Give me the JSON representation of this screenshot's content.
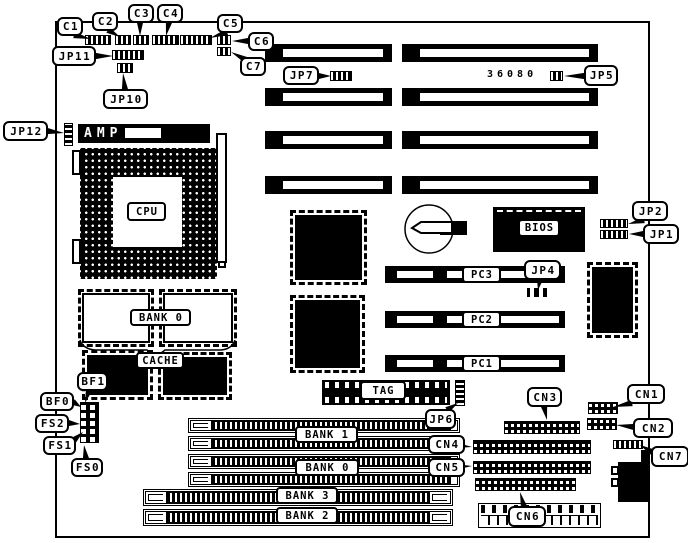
{
  "part_number": "36080",
  "callouts": {
    "c1": "C1",
    "c2": "C2",
    "c3": "C3",
    "c4": "C4",
    "c5": "C5",
    "c6": "C6",
    "c7": "C7",
    "jp11": "JP11",
    "jp10": "JP10",
    "jp12": "JP12",
    "jp7": "JP7",
    "jp5": "JP5",
    "jp2": "JP2",
    "jp1": "JP1",
    "jp4": "JP4",
    "jp6": "JP6",
    "bf1": "BF1",
    "bf0": "BF0",
    "fs2": "FS2",
    "fs1": "FS1",
    "fs0": "FS0",
    "cn1": "CN1",
    "cn2": "CN2",
    "cn3": "CN3",
    "cn4": "CN4",
    "cn5": "CN5",
    "cn6": "CN6",
    "cn7": "CN7"
  },
  "labels": {
    "cpu": "CPU",
    "amp": "AMP",
    "bios": "BIOS",
    "bank0_cache": "BANK 0",
    "cache": "CACHE",
    "tag": "TAG",
    "bank1": "BANK 1",
    "bank0": "BANK 0",
    "bank3": "BANK 3",
    "bank2": "BANK 2",
    "pc3": "PC3",
    "pc2": "PC2",
    "pc1": "PC1"
  }
}
